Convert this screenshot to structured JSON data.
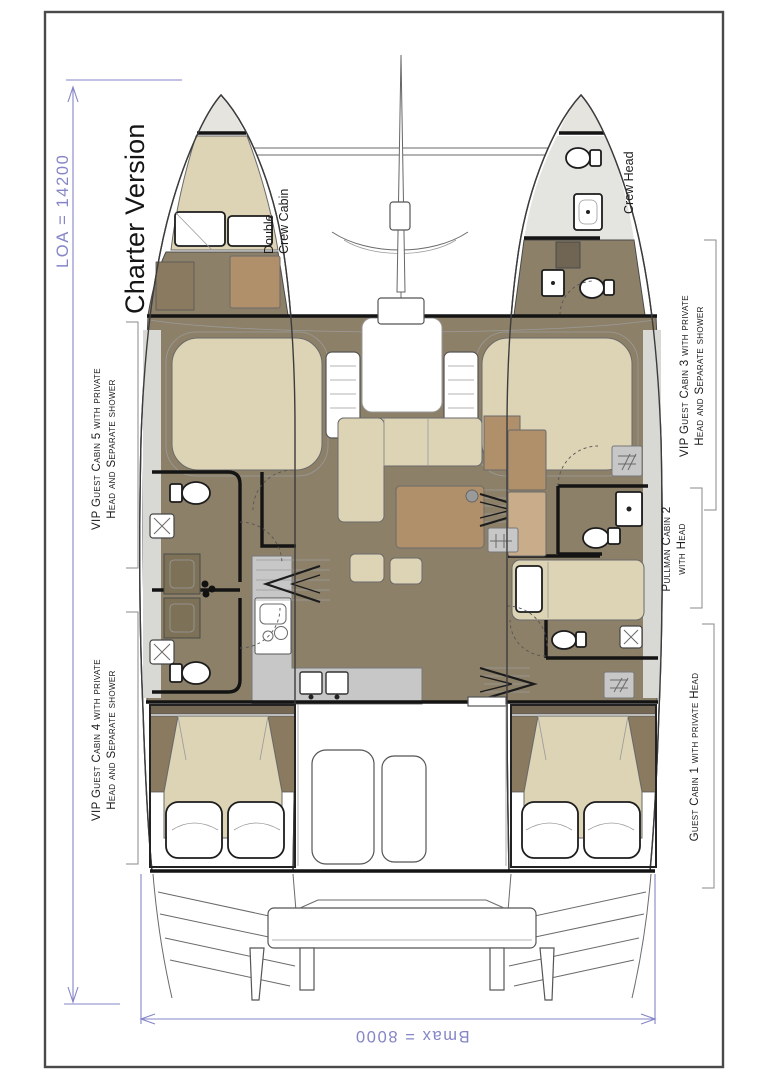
{
  "title": "Charter Version",
  "dimensions": {
    "loa": "LOA = 14200",
    "bmax": "Bmax = 8000"
  },
  "cabins": {
    "double_crew": {
      "line1": "Double",
      "line2": "Crew Cabin"
    },
    "crew_head": {
      "line1": "Crew Head"
    },
    "vip5": {
      "line1": "VIP Guest Cabin 5 with private",
      "line2": "Head and Separate shower"
    },
    "vip4": {
      "line1": "VIP Guest Cabin 4 with private",
      "line2": "Head and Separate shower"
    },
    "vip3": {
      "line1": "VIP Guest Cabin 3 with private",
      "line2": "Head and Separate shower"
    },
    "pullman2": {
      "line1": "Pullman Cabin 2",
      "line2": "with Head"
    },
    "guest1": {
      "line1": "Guest Cabin 1 with private Head"
    }
  },
  "colors": {
    "dimension_blue": "#8585c8",
    "bed_beige": "#ddd3b5",
    "floor_brown": "#8d8068",
    "furniture_brown": "#b08f6b",
    "dark_brown": "#746753",
    "counter_gray": "#c7c7c7",
    "deck_gray": "#e6e4de",
    "wall_black": "#141414"
  }
}
